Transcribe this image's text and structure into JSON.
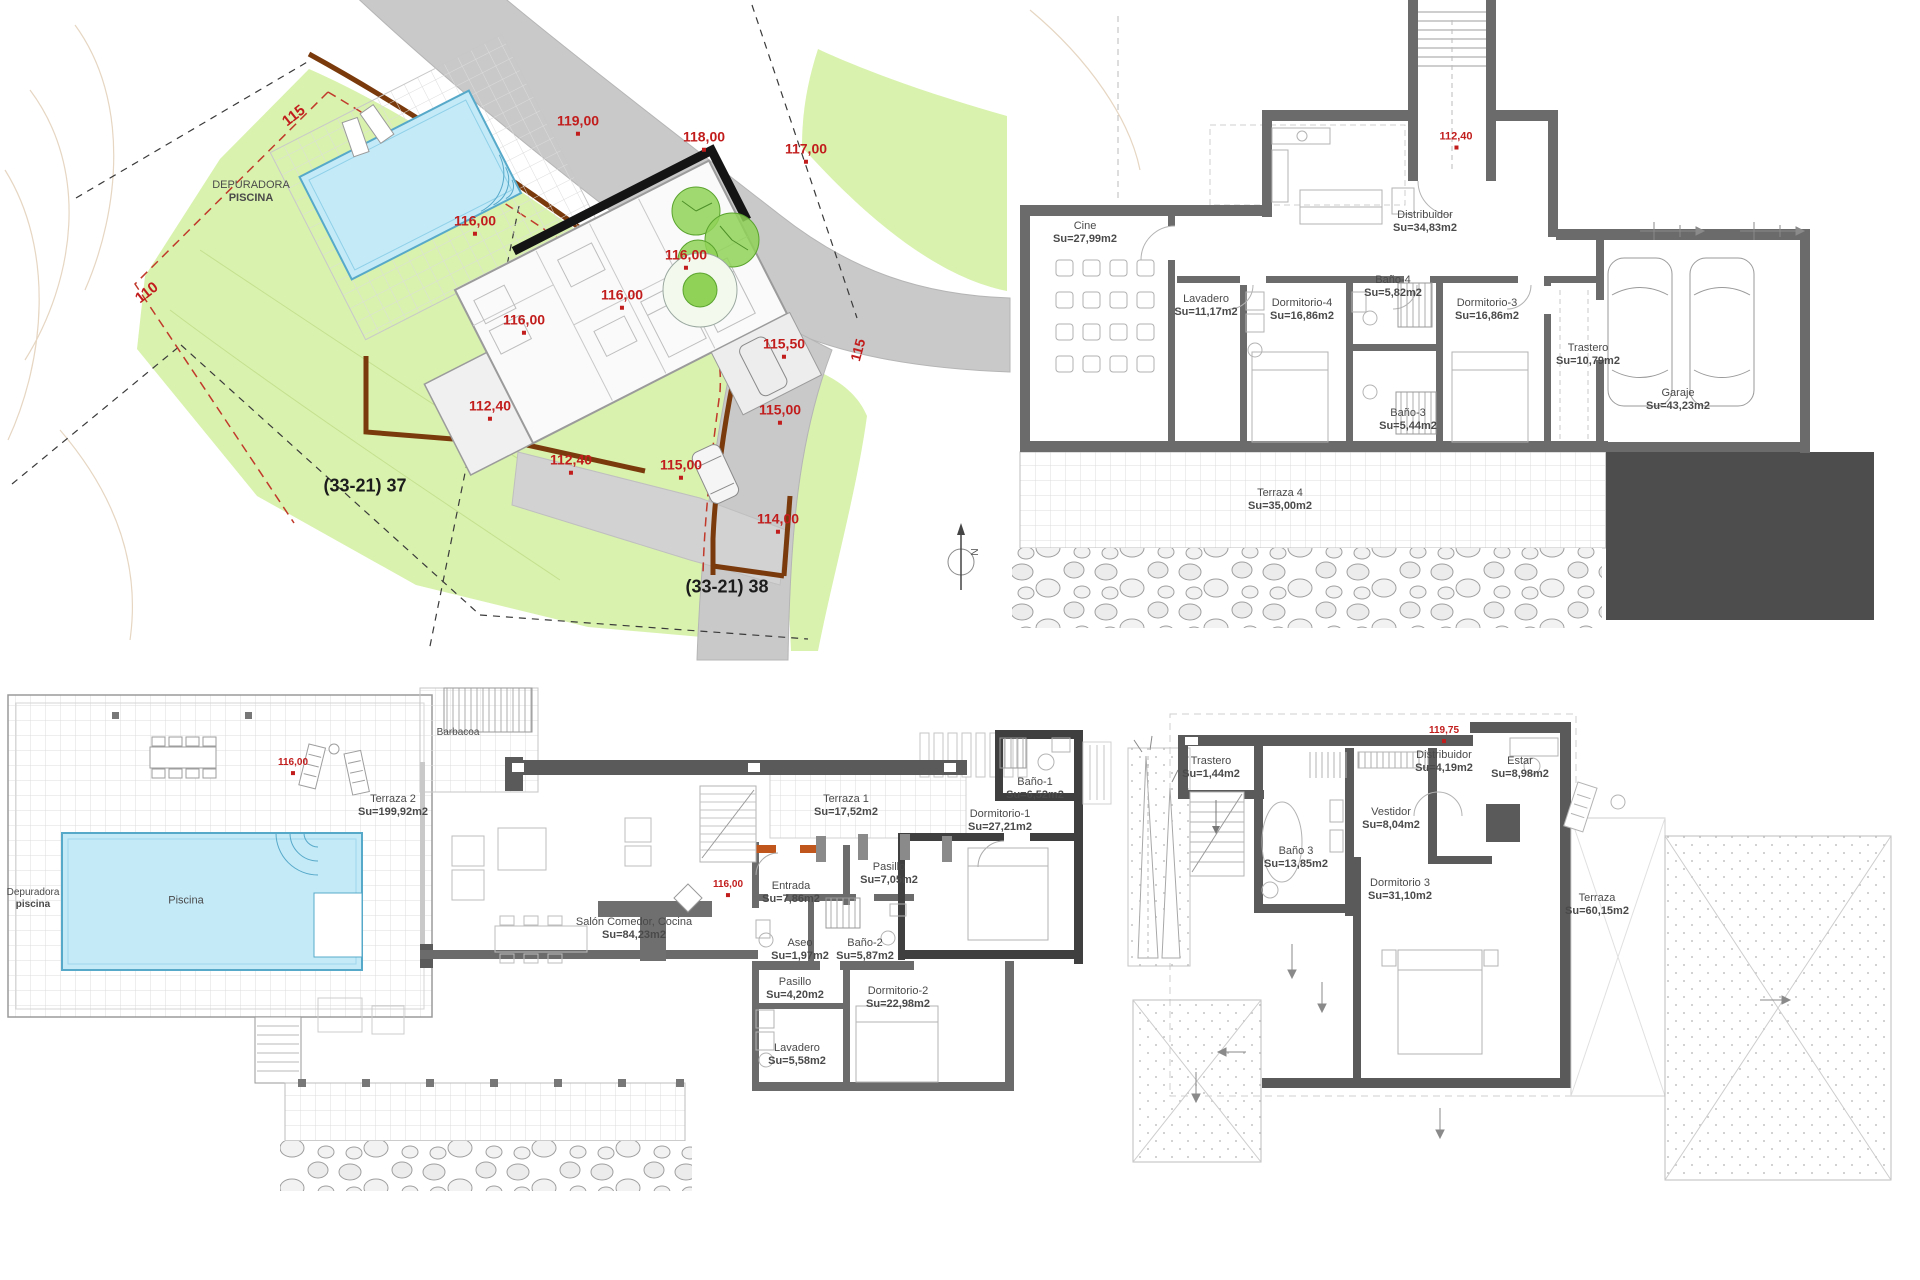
{
  "sheet": {
    "width": 1920,
    "height": 1280,
    "background": "#ffffff"
  },
  "colors": {
    "marker_red": "#c21d1d",
    "label_gray": "#4a4a4a",
    "wall_gray": "#6b6b6b",
    "wall_dark": "#3f3f3f",
    "pool_fill": "#c4eaf8",
    "pool_edge": "#57a9c9",
    "plot_green": "#d9f2ae",
    "road_gray": "#c9c9c9",
    "boundary_brown": "#7a3a0c",
    "door_orange": "#c0561c",
    "slab_dark": "#4d4d4d"
  },
  "plans": [
    {
      "id": "site-plan",
      "labels": [
        {
          "id": "contour-label-115",
          "lines": [
            "115"
          ],
          "x": 294,
          "y": 116,
          "rot": -38,
          "color": "red",
          "size": 15
        },
        {
          "id": "spot-elevation",
          "lines": [
            "119,00"
          ],
          "x": 578,
          "y": 124,
          "color": "red",
          "size": 14,
          "dot": true
        },
        {
          "id": "spot-elevation",
          "lines": [
            "118,00"
          ],
          "x": 704,
          "y": 140,
          "color": "red",
          "size": 14,
          "dot": true
        },
        {
          "id": "spot-elevation",
          "lines": [
            "117,00"
          ],
          "x": 806,
          "y": 152,
          "color": "red",
          "size": 14,
          "dot": true
        },
        {
          "id": "depuradora-piscina-label",
          "lines": [
            "DEPURADORA",
            "PISCINA"
          ],
          "x": 251,
          "y": 192,
          "color": "text",
          "size": 11
        },
        {
          "id": "spot-elevation",
          "lines": [
            "116,00"
          ],
          "x": 475,
          "y": 224,
          "color": "red",
          "size": 14,
          "dot": true
        },
        {
          "id": "spot-elevation",
          "lines": [
            "116,00"
          ],
          "x": 686,
          "y": 258,
          "color": "red",
          "size": 14,
          "dot": true
        },
        {
          "id": "contour-label-110",
          "lines": [
            "110"
          ],
          "x": 147,
          "y": 293,
          "rot": -38,
          "color": "red",
          "size": 15
        },
        {
          "id": "spot-elevation",
          "lines": [
            "116,00"
          ],
          "x": 622,
          "y": 298,
          "color": "red",
          "size": 14,
          "dot": true
        },
        {
          "id": "spot-elevation",
          "lines": [
            "116,00"
          ],
          "x": 524,
          "y": 323,
          "color": "red",
          "size": 14,
          "dot": true
        },
        {
          "id": "spot-elevation",
          "lines": [
            "115,50"
          ],
          "x": 784,
          "y": 347,
          "color": "red",
          "size": 14,
          "dot": true
        },
        {
          "id": "road-contour-label-115",
          "lines": [
            "115"
          ],
          "x": 858,
          "y": 350,
          "rot": -75,
          "color": "red",
          "size": 14
        },
        {
          "id": "spot-elevation",
          "lines": [
            "112,40"
          ],
          "x": 490,
          "y": 409,
          "color": "red",
          "size": 14,
          "dot": true
        },
        {
          "id": "spot-elevation",
          "lines": [
            "115,00"
          ],
          "x": 780,
          "y": 413,
          "color": "red",
          "size": 14,
          "dot": true
        },
        {
          "id": "spot-elevation",
          "lines": [
            "112,40"
          ],
          "x": 571,
          "y": 463,
          "color": "red",
          "size": 14,
          "dot": true
        },
        {
          "id": "spot-elevation",
          "lines": [
            "115,00"
          ],
          "x": 681,
          "y": 468,
          "color": "red",
          "size": 14,
          "dot": true
        },
        {
          "id": "parcel-label-37",
          "lines": [
            "(33-21) 37"
          ],
          "x": 365,
          "y": 486,
          "color": "black",
          "size": 18,
          "bold": true
        },
        {
          "id": "spot-elevation",
          "lines": [
            "114,00"
          ],
          "x": 778,
          "y": 522,
          "color": "red",
          "size": 14,
          "dot": true
        },
        {
          "id": "parcel-label-38",
          "lines": [
            "(33-21) 38"
          ],
          "x": 727,
          "y": 587,
          "color": "black",
          "size": 18,
          "bold": true
        },
        {
          "id": "north-label",
          "lines": [
            "N"
          ],
          "x": 976,
          "y": 552,
          "rot": -90,
          "color": "text",
          "size": 10
        }
      ]
    },
    {
      "id": "basement-plan",
      "labels": [
        {
          "id": "level-marker",
          "lines": [
            "112,40"
          ],
          "x": 1456,
          "y": 140,
          "color": "red",
          "size": 11,
          "dot": true
        },
        {
          "id": "room-label-cine",
          "lines": [
            "Cine",
            "Su=27,99m2"
          ],
          "x": 1085,
          "y": 233,
          "color": "text",
          "size": 11
        },
        {
          "id": "room-label-distribuidor",
          "lines": [
            "Distribuidor",
            "Su=34,83m2"
          ],
          "x": 1425,
          "y": 222,
          "color": "text",
          "size": 11
        },
        {
          "id": "room-label-lavadero",
          "lines": [
            "Lavadero",
            "Su=11,17m2"
          ],
          "x": 1206,
          "y": 306,
          "color": "text",
          "size": 11
        },
        {
          "id": "room-label-dormitorio-4",
          "lines": [
            "Dormitorio-4",
            "Su=16,86m2"
          ],
          "x": 1302,
          "y": 310,
          "color": "text",
          "size": 11
        },
        {
          "id": "room-label-bano-4",
          "lines": [
            "Baño-4",
            "Su=5,82m2"
          ],
          "x": 1393,
          "y": 287,
          "color": "text",
          "size": 11
        },
        {
          "id": "room-label-dormitorio-3",
          "lines": [
            "Dormitorio-3",
            "Su=16,86m2"
          ],
          "x": 1487,
          "y": 310,
          "color": "text",
          "size": 11
        },
        {
          "id": "room-label-trastero",
          "lines": [
            "Trastero",
            "Su=10,79m2"
          ],
          "x": 1588,
          "y": 355,
          "color": "text",
          "size": 11
        },
        {
          "id": "room-label-garaje",
          "lines": [
            "Garaje",
            "Su=43,23m2"
          ],
          "x": 1678,
          "y": 400,
          "color": "text",
          "size": 11
        },
        {
          "id": "room-label-bano-3",
          "lines": [
            "Baño-3",
            "Su=5,44m2"
          ],
          "x": 1408,
          "y": 420,
          "color": "text",
          "size": 11
        },
        {
          "id": "room-label-terraza-4",
          "lines": [
            "Terraza 4",
            "Su=35,00m2"
          ],
          "x": 1280,
          "y": 500,
          "color": "text",
          "size": 11
        }
      ]
    },
    {
      "id": "main-floor-plan",
      "labels": [
        {
          "id": "room-label-barbacoa",
          "lines": [
            "Barbacoa"
          ],
          "x": 458,
          "y": 733,
          "color": "text",
          "size": 10
        },
        {
          "id": "level-marker",
          "lines": [
            "116,00"
          ],
          "x": 293,
          "y": 766,
          "color": "red",
          "size": 10,
          "dot": true
        },
        {
          "id": "room-label-terraza-2",
          "lines": [
            "Terraza 2",
            "Su=199,92m2"
          ],
          "x": 393,
          "y": 806,
          "color": "text",
          "size": 11
        },
        {
          "id": "room-label-depuradora",
          "lines": [
            "Depuradora",
            "piscina"
          ],
          "x": 33,
          "y": 899,
          "color": "text",
          "size": 10
        },
        {
          "id": "room-label-piscina",
          "lines": [
            "Piscina"
          ],
          "x": 186,
          "y": 901,
          "color": "text",
          "size": 11
        },
        {
          "id": "room-label-terraza-1",
          "lines": [
            "Terraza 1",
            "Su=17,52m2"
          ],
          "x": 846,
          "y": 806,
          "color": "text",
          "size": 11
        },
        {
          "id": "room-label-pasillo-1",
          "lines": [
            "Pasillo",
            "Su=7,05m2"
          ],
          "x": 889,
          "y": 874,
          "color": "text",
          "size": 11
        },
        {
          "id": "level-marker",
          "lines": [
            "116,00"
          ],
          "x": 728,
          "y": 888,
          "color": "red",
          "size": 10,
          "dot": true
        },
        {
          "id": "room-label-entrada",
          "lines": [
            "Entrada",
            "Su=7,86m2"
          ],
          "x": 791,
          "y": 893,
          "color": "text",
          "size": 11
        },
        {
          "id": "room-label-salon",
          "lines": [
            "Salón Comedor, Cocina",
            "Su=84,23m2"
          ],
          "x": 634,
          "y": 929,
          "color": "text",
          "size": 11
        },
        {
          "id": "room-label-aseo",
          "lines": [
            "Aseo",
            "Su=1,97m2"
          ],
          "x": 800,
          "y": 950,
          "color": "text",
          "size": 11
        },
        {
          "id": "room-label-bano-2",
          "lines": [
            "Baño-2",
            "Su=5,87m2"
          ],
          "x": 865,
          "y": 950,
          "color": "text",
          "size": 11
        },
        {
          "id": "room-label-pasillo-2",
          "lines": [
            "Pasillo",
            "Su=4,20m2"
          ],
          "x": 795,
          "y": 989,
          "color": "text",
          "size": 11
        },
        {
          "id": "room-label-dormitorio-2",
          "lines": [
            "Dormitorio-2",
            "Su=22,98m2"
          ],
          "x": 898,
          "y": 998,
          "color": "text",
          "size": 11
        },
        {
          "id": "room-label-bano-1",
          "lines": [
            "Baño-1",
            "Su=6,52m2"
          ],
          "x": 1035,
          "y": 789,
          "color": "text",
          "size": 11
        },
        {
          "id": "room-label-dormitorio-1",
          "lines": [
            "Dormitorio-1",
            "Su=27,21m2"
          ],
          "x": 1000,
          "y": 821,
          "color": "text",
          "size": 11
        },
        {
          "id": "room-label-lavadero",
          "lines": [
            "Lavadero",
            "Su=5,58m2"
          ],
          "x": 797,
          "y": 1055,
          "color": "text",
          "size": 11
        }
      ]
    },
    {
      "id": "upper-floor-plan",
      "labels": [
        {
          "id": "room-label-trastero",
          "lines": [
            "Trastero",
            "Su=1,44m2"
          ],
          "x": 1211,
          "y": 768,
          "color": "text",
          "size": 11
        },
        {
          "id": "room-label-bano-3",
          "lines": [
            "Baño 3",
            "Su=13,85m2"
          ],
          "x": 1296,
          "y": 858,
          "color": "text",
          "size": 11
        },
        {
          "id": "room-label-vestidor",
          "lines": [
            "Vestidor",
            "Su=8,04m2"
          ],
          "x": 1391,
          "y": 819,
          "color": "text",
          "size": 11
        },
        {
          "id": "level-marker",
          "lines": [
            "119,75"
          ],
          "x": 1444,
          "y": 734,
          "color": "red",
          "size": 10,
          "dot": true
        },
        {
          "id": "room-label-distribuidor",
          "lines": [
            "Distribuidor",
            "Su=4,19m2"
          ],
          "x": 1444,
          "y": 762,
          "color": "text",
          "size": 11
        },
        {
          "id": "room-label-estar",
          "lines": [
            "Estar",
            "Su=8,98m2"
          ],
          "x": 1520,
          "y": 768,
          "color": "text",
          "size": 11
        },
        {
          "id": "room-label-dormitorio-3",
          "lines": [
            "Dormitorio 3",
            "Su=31,10m2"
          ],
          "x": 1400,
          "y": 890,
          "color": "text",
          "size": 11
        },
        {
          "id": "room-label-terraza",
          "lines": [
            "Terraza",
            "Su=60,15m2"
          ],
          "x": 1597,
          "y": 905,
          "color": "text",
          "size": 11
        }
      ]
    }
  ]
}
